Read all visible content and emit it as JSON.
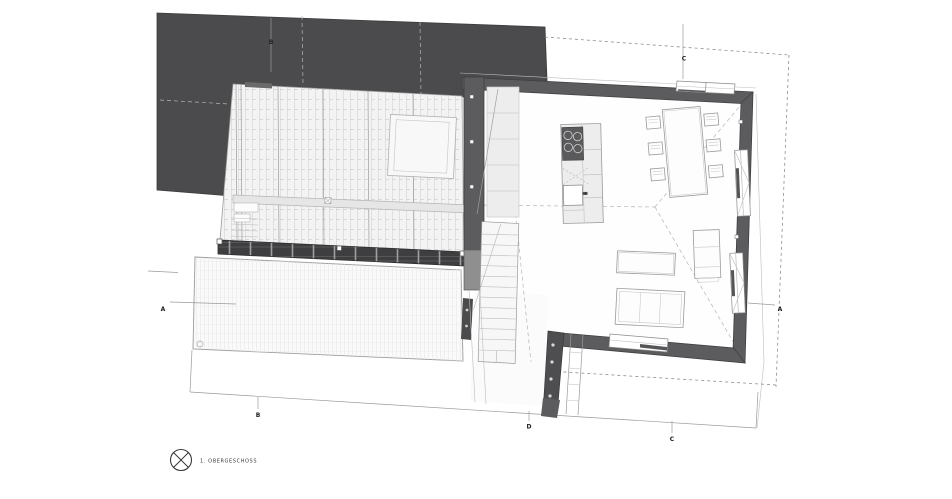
{
  "drawing": {
    "title": "1. OBERGESCHOSS",
    "legend": {
      "label": "1. OBERGESCHOSS",
      "symbol": "orientation-circle-x"
    },
    "section_markers": [
      {
        "id": "B-top",
        "label": "B"
      },
      {
        "id": "C-top",
        "label": "C"
      },
      {
        "id": "A-left",
        "label": "A"
      },
      {
        "id": "A-right",
        "label": "A"
      },
      {
        "id": "B-bottom",
        "label": "B"
      },
      {
        "id": "D-bottom",
        "label": "D"
      },
      {
        "id": "C-bottom",
        "label": "C"
      }
    ],
    "colors": {
      "background": "#ffffff",
      "roof_dark": "#4b4b4d",
      "wall": "#5c5c5e",
      "wall_light": "#8f8f8f",
      "railing": "#3e3e40",
      "glass_fill": "#f3f3f3",
      "terrace_fill": "#fafafa",
      "stair_fill": "#f7f7f7",
      "void_fill": "#ededed",
      "line": "#9a9a9a",
      "dashed": "#8f8f8f"
    }
  }
}
